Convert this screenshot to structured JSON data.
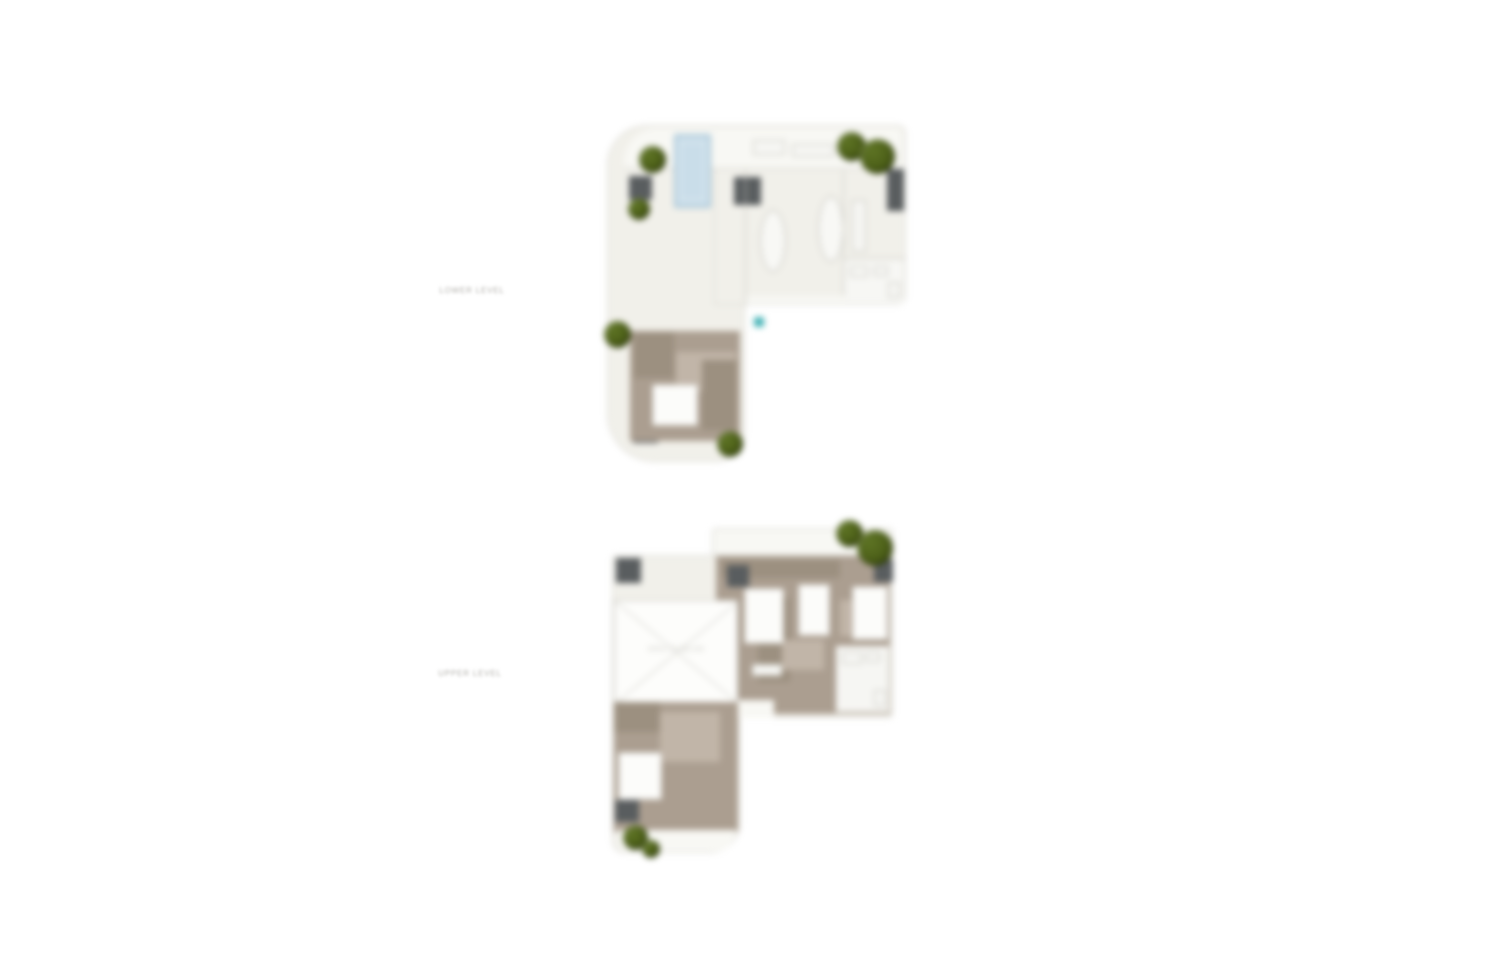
{
  "page": {
    "background_color": "#ffffff"
  },
  "palette": {
    "floor": "#f1f0ea",
    "terrace": "#f8f8f4",
    "wall_line": "#d8d7d1",
    "carpet": "#ab9e90",
    "carpet_dark": "#9c9080",
    "carpet_light": "#c1b5a8",
    "pool_water": "#c9dde9",
    "pool_edge": "#a3c2d4",
    "tree_foliage": "#4c5f18",
    "core_shaft": "#595d5f",
    "marker_teal": "#45b3b6",
    "label_text": "#b3b1ac"
  },
  "icons": {
    "tree": "tree-icon",
    "pool": "swimming-pool",
    "shaft": "core-shaft",
    "void_cross": "void-cross-icon",
    "marker": "teal-marker-icon"
  },
  "plans": [
    {
      "id": "lower",
      "label": "LOWER LEVEL"
    },
    {
      "id": "upper",
      "label": "UPPER LEVEL",
      "void_label": "OPEN TO BELOW"
    }
  ]
}
